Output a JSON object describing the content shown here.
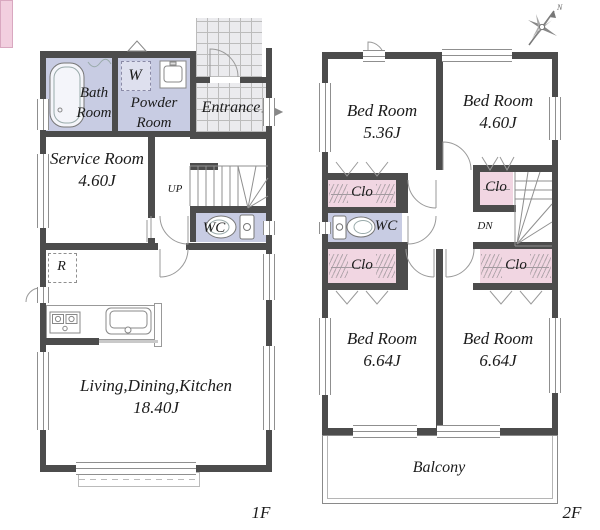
{
  "colors": {
    "wall": "#4c4c4c",
    "room_lavender": "#c8cce3",
    "closet_pink": "#f1d6e2",
    "entrance_mat_pink": "#f2cfdf",
    "tile_bg": "#ebebee",
    "line": "#8f8f8f",
    "text": "#1b1b1b"
  },
  "floor1": {
    "tag": "1F",
    "bath": {
      "label": "Bath Room"
    },
    "powder": {
      "label": "Powder Room",
      "washer": "W"
    },
    "entrance": {
      "label": "Entrance"
    },
    "service": {
      "label": "Service Room",
      "area": "4.60J"
    },
    "stairs": {
      "label": "UP"
    },
    "wc": {
      "label": "WC"
    },
    "fridge": {
      "label": "R"
    },
    "ldk": {
      "label": "Living,Dining,Kitchen",
      "area": "18.40J"
    }
  },
  "floor2": {
    "tag": "2F",
    "compass_north": "N",
    "bed1": {
      "label": "Bed Room",
      "area": "5.36J"
    },
    "bed2": {
      "label": "Bed Room",
      "area": "4.60J"
    },
    "bed3": {
      "label": "Bed Room",
      "area": "6.64J"
    },
    "bed4": {
      "label": "Bed Room",
      "area": "6.64J"
    },
    "wc": {
      "label": "WC"
    },
    "stairs": {
      "label": "DN"
    },
    "clo_top_left": {
      "label": "Clo"
    },
    "clo_mid_left": {
      "label": "Clo"
    },
    "clo_top_right": {
      "label": "Clo"
    },
    "clo_mid_right": {
      "label": "Clo"
    },
    "balcony": {
      "label": "Balcony"
    }
  }
}
